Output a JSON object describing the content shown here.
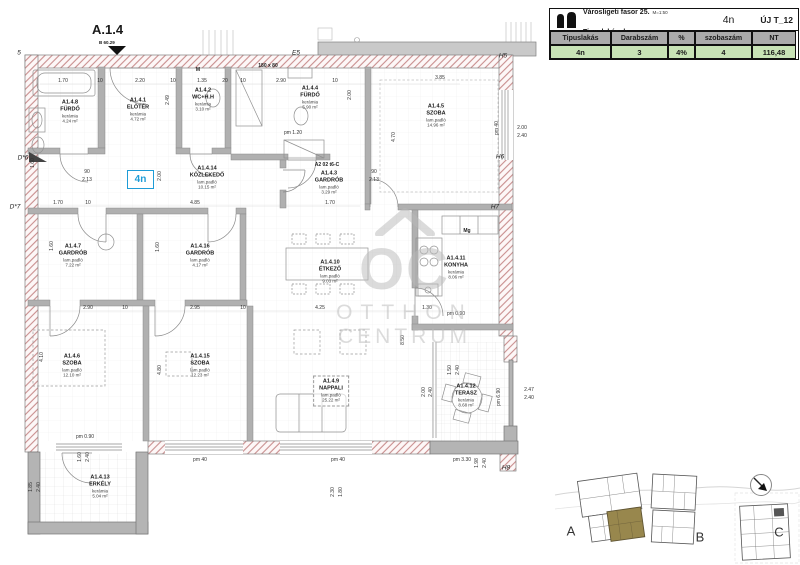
{
  "table": {
    "project": "Városligeti fasor 25.",
    "scale": "M=1:50",
    "subtitle": "Tipuslakások",
    "date": "2025. 04. 24.",
    "unit": "4n",
    "sheet": "ÚJ T_12",
    "columns": [
      "Tipuslakás",
      "Darabszám",
      "%",
      "szobaszám",
      "NT"
    ],
    "row": [
      "4n",
      "3",
      "4%",
      "4",
      "116,48"
    ]
  },
  "plan": {
    "section_title": "A.1.4",
    "section_sub": "B 60.29",
    "unit_badge": "4n",
    "rooms": [
      {
        "id": "A1.4.8",
        "name": "FÜRDŐ",
        "floor": "kerámia",
        "area": "4.24 m²",
        "x": 70,
        "y": 112
      },
      {
        "id": "A1.4.1",
        "name": "ELŐTÉR",
        "floor": "kerámia",
        "area": "4.72 m²",
        "x": 138,
        "y": 110
      },
      {
        "id": "A1.4.2",
        "name": "WC+H.H",
        "floor": "kerámia",
        "area": "3.10 m²",
        "x": 203,
        "y": 100
      },
      {
        "id": "A1.4.4",
        "name": "FÜRDŐ",
        "floor": "kerámia",
        "area": "5.90 m²",
        "x": 310,
        "y": 98
      },
      {
        "id": "A1.4.5",
        "name": "SZOBA",
        "floor": "lam.padló",
        "area": "14.96 m²",
        "x": 436,
        "y": 116
      },
      {
        "id": "A1.4.3",
        "name": "GARDRÓB",
        "floor": "lam.padló",
        "area": "3.29 m²",
        "x": 329,
        "y": 183
      },
      {
        "id": "A1.4.14",
        "name": "KÖZLEKEDŐ",
        "floor": "lam.padló",
        "area": "10.15 m²",
        "x": 207,
        "y": 178
      },
      {
        "id": "A1.4.7",
        "name": "GARDRÓB",
        "floor": "lam.padló",
        "area": "7.22 m²",
        "x": 73,
        "y": 256
      },
      {
        "id": "A1.4.16",
        "name": "GARDRÓB",
        "floor": "lam.padló",
        "area": "4.17 m²",
        "x": 200,
        "y": 256
      },
      {
        "id": "A1.4.10",
        "name": "ÉTKEZŐ",
        "floor": "lam.padló",
        "area": "9.03 m²",
        "x": 330,
        "y": 272
      },
      {
        "id": "A1.4.11",
        "name": "KONYHA",
        "floor": "kerámia",
        "area": "8.06 m²",
        "x": 456,
        "y": 268
      },
      {
        "id": "A1.4.6",
        "name": "SZOBA",
        "floor": "lam.padló",
        "area": "12.10 m²",
        "x": 72,
        "y": 366
      },
      {
        "id": "A1.4.15",
        "name": "SZOBA",
        "floor": "lam.padló",
        "area": "12.23 m²",
        "x": 200,
        "y": 366
      },
      {
        "id": "A1.4.9",
        "name": "NAPPALI",
        "floor": "lam.padló",
        "area": "25.22 m²",
        "x": 331,
        "y": 391,
        "box": 1
      },
      {
        "id": "A1.4.12",
        "name": "TERASZ",
        "floor": "kerámia",
        "area": "8.68 m²",
        "x": 466,
        "y": 396
      },
      {
        "id": "A1.4.13",
        "name": "ERKÉLY",
        "floor": "kerámia",
        "area": "5.04 m²",
        "x": 100,
        "y": 487
      }
    ],
    "markers": [
      {
        "t": "5",
        "x": 19,
        "y": 53
      },
      {
        "t": "E5",
        "x": 296,
        "y": 53
      },
      {
        "t": "H5",
        "x": 503,
        "y": 56
      },
      {
        "t": "M",
        "x": 198,
        "y": 70,
        "plain": 1
      },
      {
        "t": "H6",
        "x": 500,
        "y": 157
      },
      {
        "t": "H7",
        "x": 495,
        "y": 207
      },
      {
        "t": "D*6",
        "x": 23,
        "y": 158
      },
      {
        "t": "D*7",
        "x": 15,
        "y": 207
      },
      {
        "t": "H8",
        "x": 506,
        "y": 468
      },
      {
        "t": "Mg",
        "x": 467,
        "y": 231,
        "plain": 1
      },
      {
        "t": "A2 02 t6-C",
        "x": 327,
        "y": 165,
        "plain": 1
      },
      {
        "t": "180 x 80",
        "x": 268,
        "y": 66,
        "plain": 1
      }
    ],
    "dimensions": [
      {
        "t": "1.70",
        "x": 63,
        "y": 81
      },
      {
        "t": "10",
        "x": 100,
        "y": 81
      },
      {
        "t": "2.20",
        "x": 140,
        "y": 81
      },
      {
        "t": "10",
        "x": 173,
        "y": 81
      },
      {
        "t": "1.35",
        "x": 202,
        "y": 81
      },
      {
        "t": "20",
        "x": 225,
        "y": 81
      },
      {
        "t": "10",
        "x": 243,
        "y": 81
      },
      {
        "t": "2.90",
        "x": 281,
        "y": 81
      },
      {
        "t": "10",
        "x": 335,
        "y": 81
      },
      {
        "t": "3.85",
        "x": 440,
        "y": 78
      },
      {
        "t": "2.49",
        "x": 168,
        "y": 100,
        "r": 1
      },
      {
        "t": "2.00",
        "x": 350,
        "y": 95,
        "r": 1
      },
      {
        "t": "4.70",
        "x": 394,
        "y": 137,
        "r": 1
      },
      {
        "t": "pm 40",
        "x": 497,
        "y": 128,
        "r": 1
      },
      {
        "t": "2.00",
        "x": 522,
        "y": 128
      },
      {
        "t": "2.40",
        "x": 522,
        "y": 136
      },
      {
        "t": "pm 1.20",
        "x": 293,
        "y": 133
      },
      {
        "t": "90",
        "x": 87,
        "y": 172
      },
      {
        "t": "2.13",
        "x": 87,
        "y": 180
      },
      {
        "t": "2.00",
        "x": 160,
        "y": 176,
        "r": 1
      },
      {
        "t": "90",
        "x": 374,
        "y": 172
      },
      {
        "t": "2.13",
        "x": 374,
        "y": 180
      },
      {
        "t": "1.70",
        "x": 58,
        "y": 203
      },
      {
        "t": "10",
        "x": 88,
        "y": 203
      },
      {
        "t": "4.85",
        "x": 195,
        "y": 203
      },
      {
        "t": "1.70",
        "x": 330,
        "y": 203
      },
      {
        "t": "1.60",
        "x": 33,
        "y": 163,
        "r": 1
      },
      {
        "t": "1.60",
        "x": 52,
        "y": 246,
        "r": 1
      },
      {
        "t": "1.60",
        "x": 158,
        "y": 247,
        "r": 1
      },
      {
        "t": "2.90",
        "x": 88,
        "y": 308
      },
      {
        "t": "10",
        "x": 125,
        "y": 308
      },
      {
        "t": "2.95",
        "x": 195,
        "y": 308
      },
      {
        "t": "10",
        "x": 243,
        "y": 308
      },
      {
        "t": "4.25",
        "x": 320,
        "y": 308
      },
      {
        "t": "1.30",
        "x": 427,
        "y": 308
      },
      {
        "t": "pm 0.90",
        "x": 456,
        "y": 314
      },
      {
        "t": "4.10",
        "x": 42,
        "y": 357,
        "r": 1
      },
      {
        "t": "4.80",
        "x": 160,
        "y": 370,
        "r": 1
      },
      {
        "t": "8.50",
        "x": 403,
        "y": 340,
        "r": 1
      },
      {
        "t": "1.50",
        "x": 450,
        "y": 370,
        "r": 1
      },
      {
        "t": "2.40",
        "x": 458,
        "y": 370,
        "r": 1
      },
      {
        "t": "2.00",
        "x": 424,
        "y": 392,
        "r": 1
      },
      {
        "t": "2.40",
        "x": 431,
        "y": 392,
        "r": 1
      },
      {
        "t": "pm 6.90",
        "x": 499,
        "y": 397,
        "r": 1
      },
      {
        "t": "2.47",
        "x": 529,
        "y": 390
      },
      {
        "t": "2.40",
        "x": 529,
        "y": 398
      },
      {
        "t": "pm 40",
        "x": 200,
        "y": 460
      },
      {
        "t": "pm 40",
        "x": 338,
        "y": 460
      },
      {
        "t": "pm 3.30",
        "x": 462,
        "y": 460
      },
      {
        "t": "2.30",
        "x": 333,
        "y": 492,
        "r": 1
      },
      {
        "t": "1.80",
        "x": 341,
        "y": 492,
        "r": 1
      },
      {
        "t": "1.98",
        "x": 477,
        "y": 463,
        "r": 1
      },
      {
        "t": "2.40",
        "x": 485,
        "y": 463,
        "r": 1
      },
      {
        "t": "pm 0.90",
        "x": 85,
        "y": 437
      },
      {
        "t": "1.60",
        "x": 80,
        "y": 457,
        "r": 1
      },
      {
        "t": "2.40",
        "x": 88,
        "y": 457,
        "r": 1
      },
      {
        "t": "1.85",
        "x": 31,
        "y": 487,
        "r": 1
      },
      {
        "t": "2.40",
        "x": 39,
        "y": 487,
        "r": 1
      }
    ]
  },
  "watermark": {
    "mark": "OC",
    "line1": "OTTHON",
    "line2": "CENTRUM"
  },
  "site": {
    "buildings": [
      {
        "label": "A",
        "x": 571,
        "y": 531
      },
      {
        "label": "B",
        "x": 700,
        "y": 537
      },
      {
        "label": "C",
        "x": 779,
        "y": 532
      }
    ]
  },
  "colors": {
    "badge_blue": "#1e9cd7",
    "table_header_gray": "#ababab",
    "table_value_green": "#c8e3b6",
    "wall_hatch_red": "#c98e8e",
    "wall_gray": "#b4b4b4",
    "site_highlight_olive": "#98874d",
    "watermark_gray": "#b9b9b9"
  }
}
